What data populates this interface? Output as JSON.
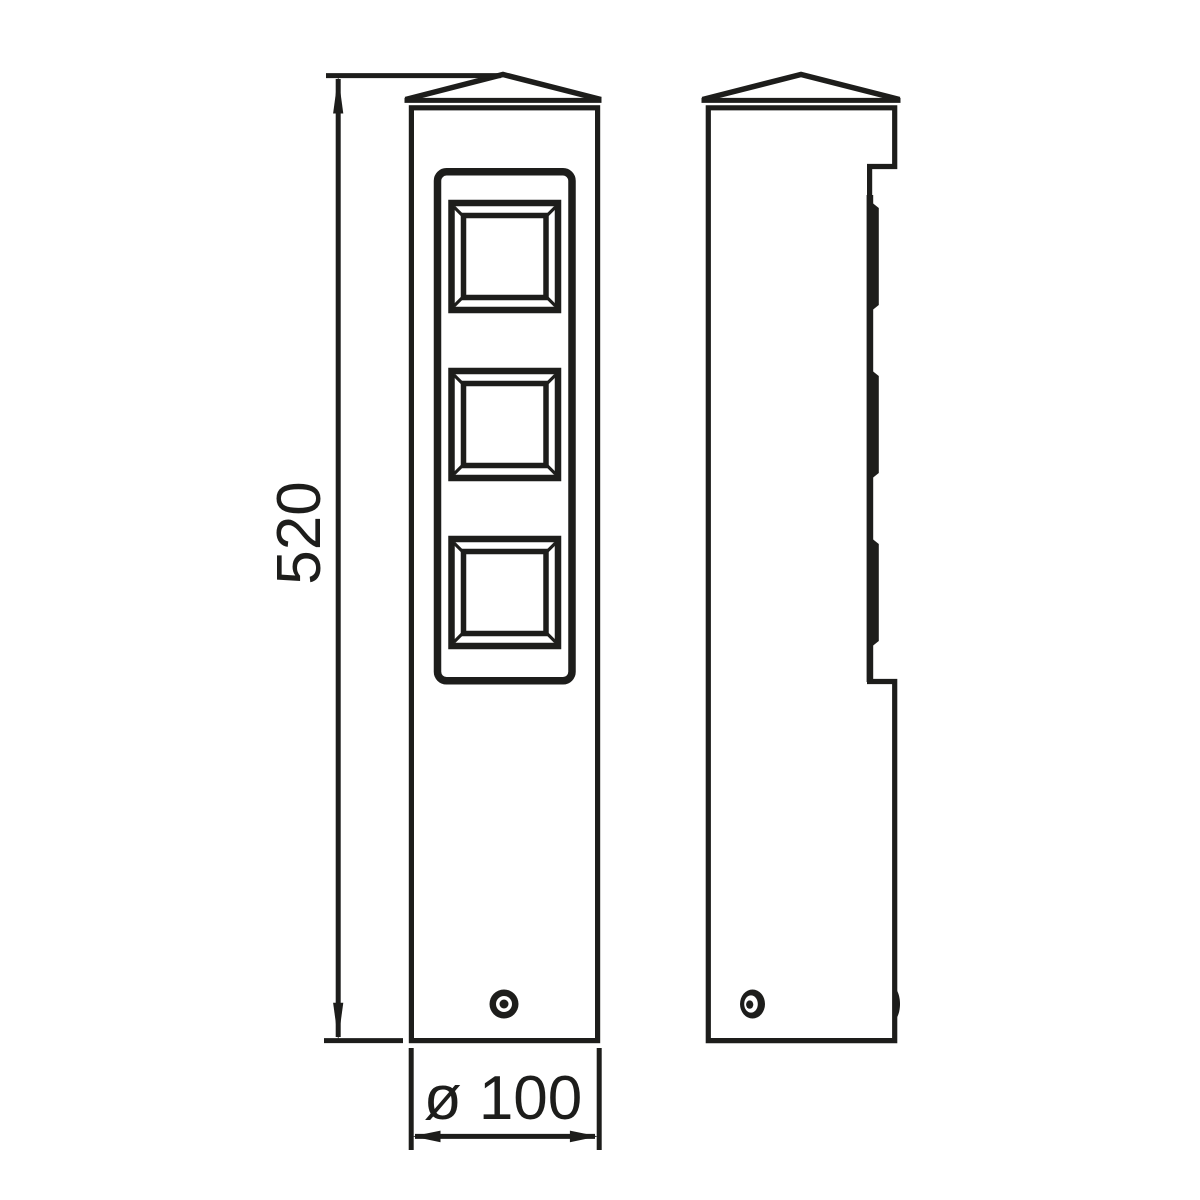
{
  "figure": {
    "kind": "technical-dimension-drawing",
    "background": "#ffffff",
    "line_color": "#1d1d1b",
    "views": [
      {
        "name": "front-elevation",
        "features": [
          "peaked-cap",
          "recessed-louver-panel",
          "three-beveled-square-windows",
          "fixing-screw"
        ]
      },
      {
        "name": "side-elevation",
        "features": [
          "peaked-cap",
          "stepped-louver-profile",
          "three-bevel-ribs",
          "fixing-screw"
        ]
      }
    ]
  },
  "dimensions": {
    "height": {
      "label": "520"
    },
    "width": {
      "label": "ø 100"
    }
  }
}
